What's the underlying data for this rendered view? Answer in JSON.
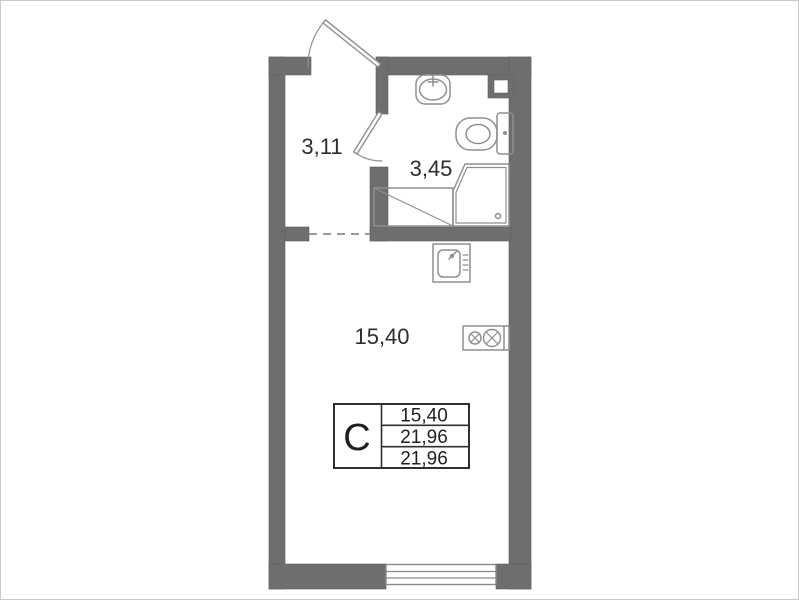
{
  "plan": {
    "title": "studio-apartment-floor-plan",
    "rooms": [
      {
        "id": "hallway",
        "area_label": "3,11"
      },
      {
        "id": "bathroom",
        "area_label": "3,45"
      },
      {
        "id": "living-room",
        "area_label": "15,40"
      }
    ],
    "legend_table": {
      "type_letter": "С",
      "rows": [
        "15,40",
        "21,96",
        "21,96"
      ]
    },
    "fixtures": [
      "entrance-door",
      "bathroom-door",
      "washbasin",
      "toilet",
      "shower-tray",
      "appliance-niche",
      "kitchen-sink",
      "stove-2-burner",
      "window",
      "vent-duct"
    ],
    "colors": {
      "wall": "#6e6e71",
      "fixture_line": "#8f8f92",
      "text": "#2d2d2d",
      "table_border": "#2f2f2f",
      "background": "#ffffff"
    }
  }
}
